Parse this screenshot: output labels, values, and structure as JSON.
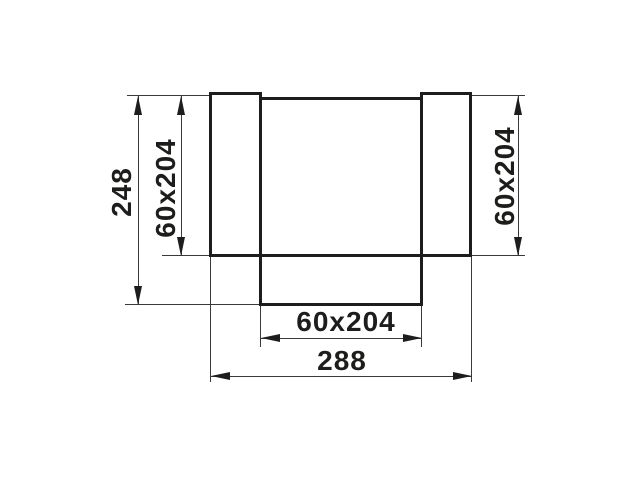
{
  "drawing": {
    "type": "duct-tee-fitting-technical-drawing",
    "background_color": "#ffffff",
    "line_color": "#1d1d1b",
    "dimensions": {
      "overall_height": "248",
      "overall_width": "288",
      "left_port": "60x204",
      "right_port": "60x204",
      "bottom_port": "60x204"
    }
  }
}
